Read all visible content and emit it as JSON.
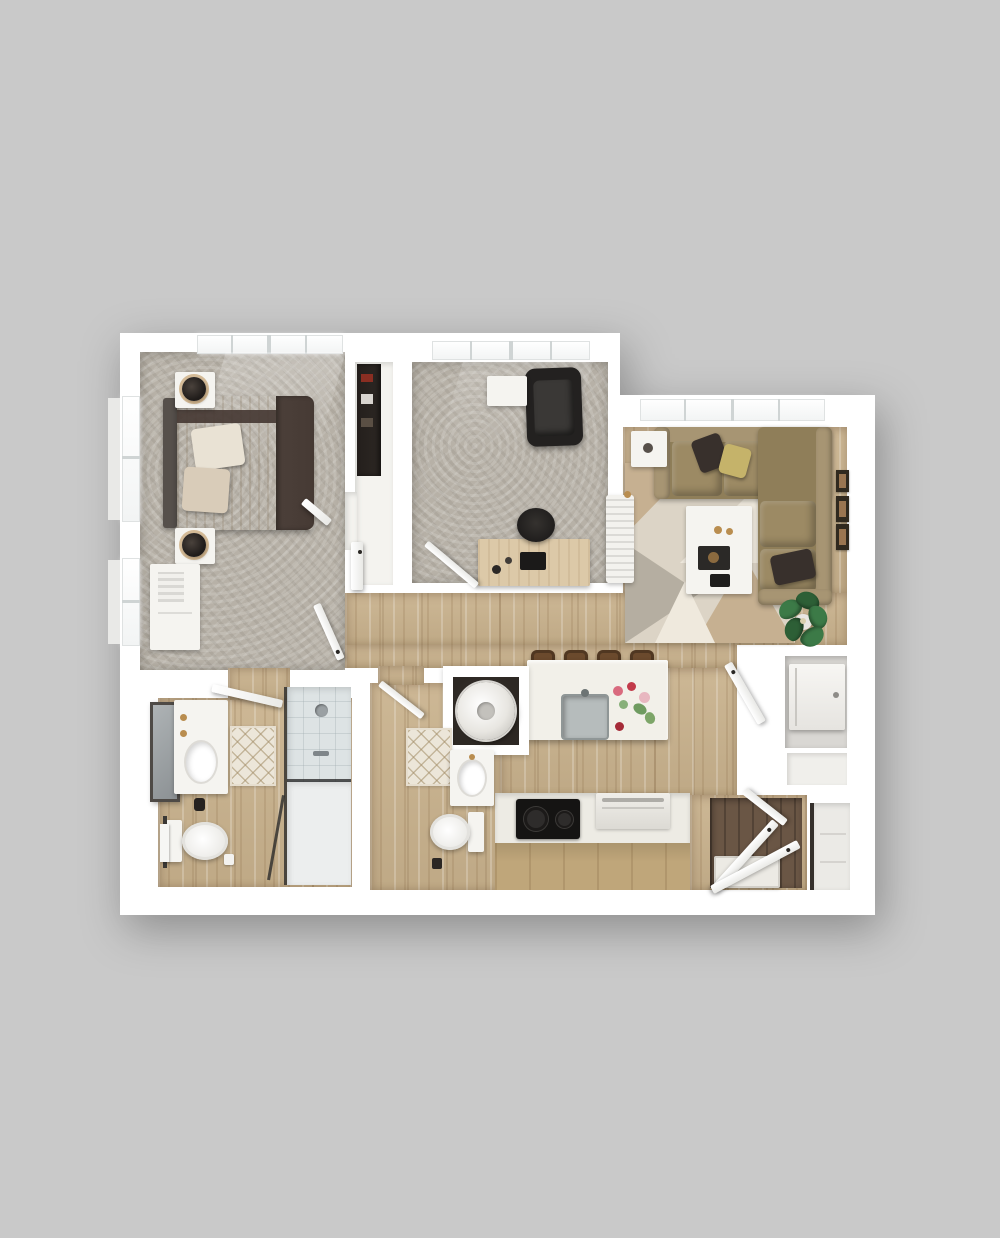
{
  "title": "3D rendered top-down apartment floor plan, two bedrooms and two bathrooms, on plain gray background",
  "colors": {
    "background": "#c9c9c9",
    "wall": "#ffffff",
    "carpet": "#b7b1a7",
    "wood": "#c9b28d",
    "closet_floor": "#f4f3ef",
    "furniture_white": "#f5f4f0",
    "sofa": "#8f7e59",
    "sofa_light": "#9c8a64",
    "sofa_back": "#a79573",
    "duvet": "#463a34",
    "sheet_light": "#e8ddca",
    "sheet_dark": "#cfc0a8",
    "pillow_light": "#e9e2d4",
    "pillow_dark_bed": "#d9ccb9",
    "black_furniture": "#232120",
    "desk_wood": "#dcc9a8",
    "island_top": "#f2f0e9",
    "steel": "#b6bcbc",
    "cabinet_wood": "#bfa67a",
    "stool": "#6b4a2d",
    "shower_tile": "#dde3e4",
    "bath_mat": "#ece6d9",
    "plant": "#3c7a47",
    "plant_dark": "#2d5f36",
    "entry_floor": "#6a5645",
    "gold": "#b98d4f",
    "closet_dark": "#2d2824",
    "rug_base": "#dcd4c6",
    "rug_tan": "#c6b091",
    "rug_gray": "#b5aea1",
    "rug_cream": "#efe9dd",
    "frame_art": "#9a7551",
    "pillow_accent_yellow": "#c5b36a",
    "pillow_accent_dark": "#38302c"
  },
  "rooms": [
    {
      "name": "bedroom",
      "objects": [
        "queen-bed",
        "two-nightstands",
        "two-table-lamps",
        "dresser-cabinet",
        "corner-windows"
      ]
    },
    {
      "name": "walk-in-closet",
      "objects": [
        "shelving",
        "hanging-clothes",
        "closet-door"
      ]
    },
    {
      "name": "office-den",
      "objects": [
        "desk",
        "laptop",
        "office-chair",
        "black-armchair",
        "side-table"
      ]
    },
    {
      "name": "living-room",
      "objects": [
        "l-shaped-sectional-sofa",
        "throw-pillows",
        "coffee-table",
        "geometric-rug",
        "side-table",
        "radiator",
        "potted-plant",
        "wall-art-frames"
      ]
    },
    {
      "name": "kitchen",
      "objects": [
        "island-with-sink",
        "four-bar-stools",
        "flower-vase",
        "cooktop",
        "dishwasher",
        "cabinets"
      ]
    },
    {
      "name": "laundry-closet",
      "objects": [
        "washer-dryer"
      ]
    },
    {
      "name": "bathroom-1",
      "objects": [
        "vanity-sink",
        "mirror",
        "toilet",
        "bath-mat",
        "walk-in-shower",
        "towel-rail"
      ]
    },
    {
      "name": "bathroom-2",
      "objects": [
        "vanity-sink",
        "toilet",
        "bath-mat"
      ]
    },
    {
      "name": "entry",
      "objects": [
        "entry-doors",
        "door-mat",
        "dark-wood-floor"
      ]
    },
    {
      "name": "utility-closets",
      "objects": [
        "water-heater",
        "storage-closet"
      ]
    }
  ]
}
